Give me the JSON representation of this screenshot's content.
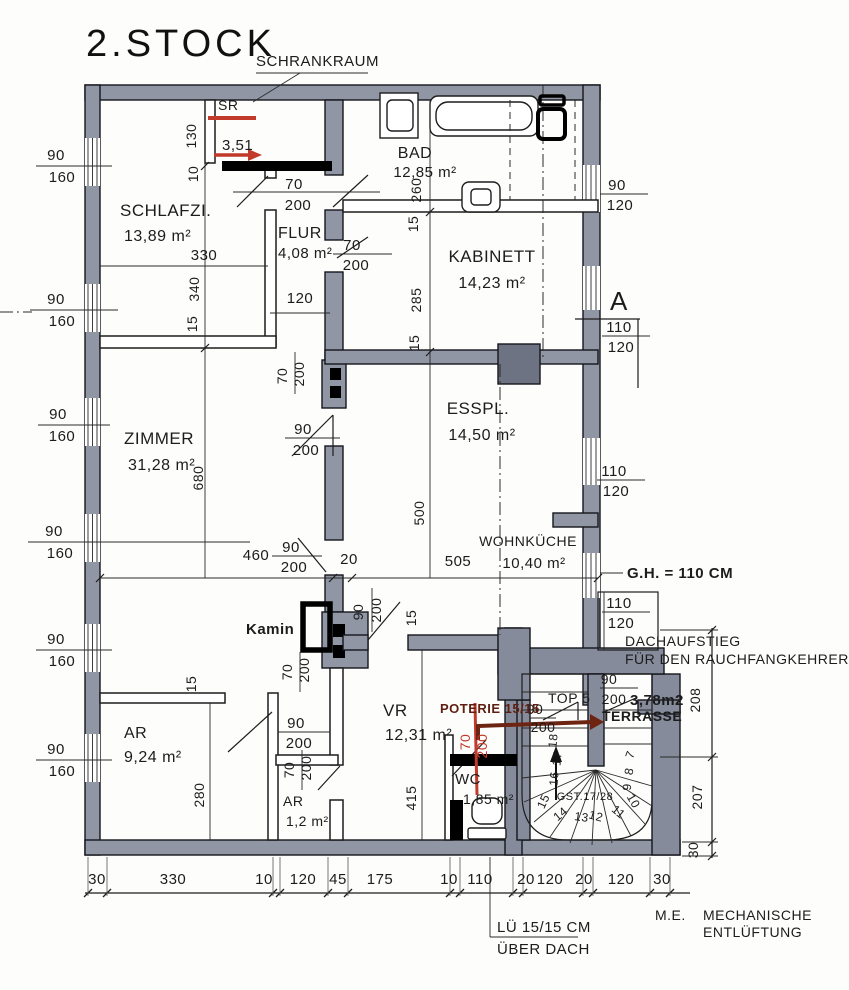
{
  "title": "2.STOCK",
  "colors": {
    "paper": "#fdfdfb",
    "wall_fill": "#9096a4",
    "wall_dark": "#6e7383",
    "stair_fill": "#858b9a",
    "line": "#1d1d1d",
    "marker_black": "#000000",
    "annotation_red": "#c23a2a",
    "annotation_dark_red": "#6e2413"
  },
  "labels": {
    "schrankraum": "SCHRANKRAUM",
    "sr": "SR",
    "sr_length": "3,51",
    "kamin": "Kamin",
    "gh": "G.H. = 110 CM",
    "dach_line1": "DACHAUFSTIEG",
    "dach_line2": "FÜR DEN RAUCHFANGKEHRER",
    "top5": "TOP 5",
    "top5_area": "3,78m2",
    "terrasse": "TERRASSE",
    "poterie": "POTERIE 15/15",
    "stair": "GST.17/28",
    "section_a": "A",
    "me": "M.E.",
    "mech1": "MECHANISCHE",
    "mech2": "ENTLÜFTUNG",
    "lue1": "LÜ 15/15 CM",
    "lue2": "ÜBER DACH"
  },
  "rooms": {
    "schlafzi": {
      "name": "SCHLAFZI.",
      "area": "13,89 m²"
    },
    "bad": {
      "name": "BAD",
      "area": "12,85 m²"
    },
    "flur": {
      "name": "FLUR",
      "area": "4,08 m²"
    },
    "kabinett": {
      "name": "KABINETT",
      "area": "14,23 m²"
    },
    "zimmer": {
      "name": "ZIMMER",
      "area": "31,28 m²"
    },
    "esspl": {
      "name": "ESSPL.",
      "area": "14,50 m²"
    },
    "wohnkueche": {
      "name": "WOHNKÜCHE",
      "area": "10,40 m²"
    },
    "vr": {
      "name": "VR",
      "area": "12,31 m²"
    },
    "ar": {
      "name": "AR",
      "area": "9,24 m²"
    },
    "ar_klein": {
      "name": "AR",
      "area": "1,2 m²"
    },
    "wc": {
      "name": "WC",
      "area": "1,85 m²"
    }
  },
  "dims": {
    "w90": "90",
    "w160": "160",
    "w110": "110",
    "w120": "120",
    "d70": "70",
    "d200": "200",
    "v130": "130",
    "v10": "10",
    "v330": "330",
    "v340": "340",
    "v15": "15",
    "v120": "120",
    "v260": "260",
    "v285": "285",
    "v500": "500",
    "v505": "505",
    "v680": "680",
    "v460": "460",
    "v20": "20",
    "v280": "280",
    "v415": "415",
    "v208": "208",
    "v207": "207",
    "v30": "30"
  },
  "bottom_chain": [
    "30",
    "330",
    "10",
    "120",
    "45",
    "175",
    "10",
    "110",
    "20",
    "120",
    "20",
    "120",
    "30"
  ],
  "stair_steps": [
    "7",
    "8",
    "9",
    "10",
    "11",
    "12",
    "13",
    "14",
    "15",
    "16",
    "17",
    "18"
  ]
}
